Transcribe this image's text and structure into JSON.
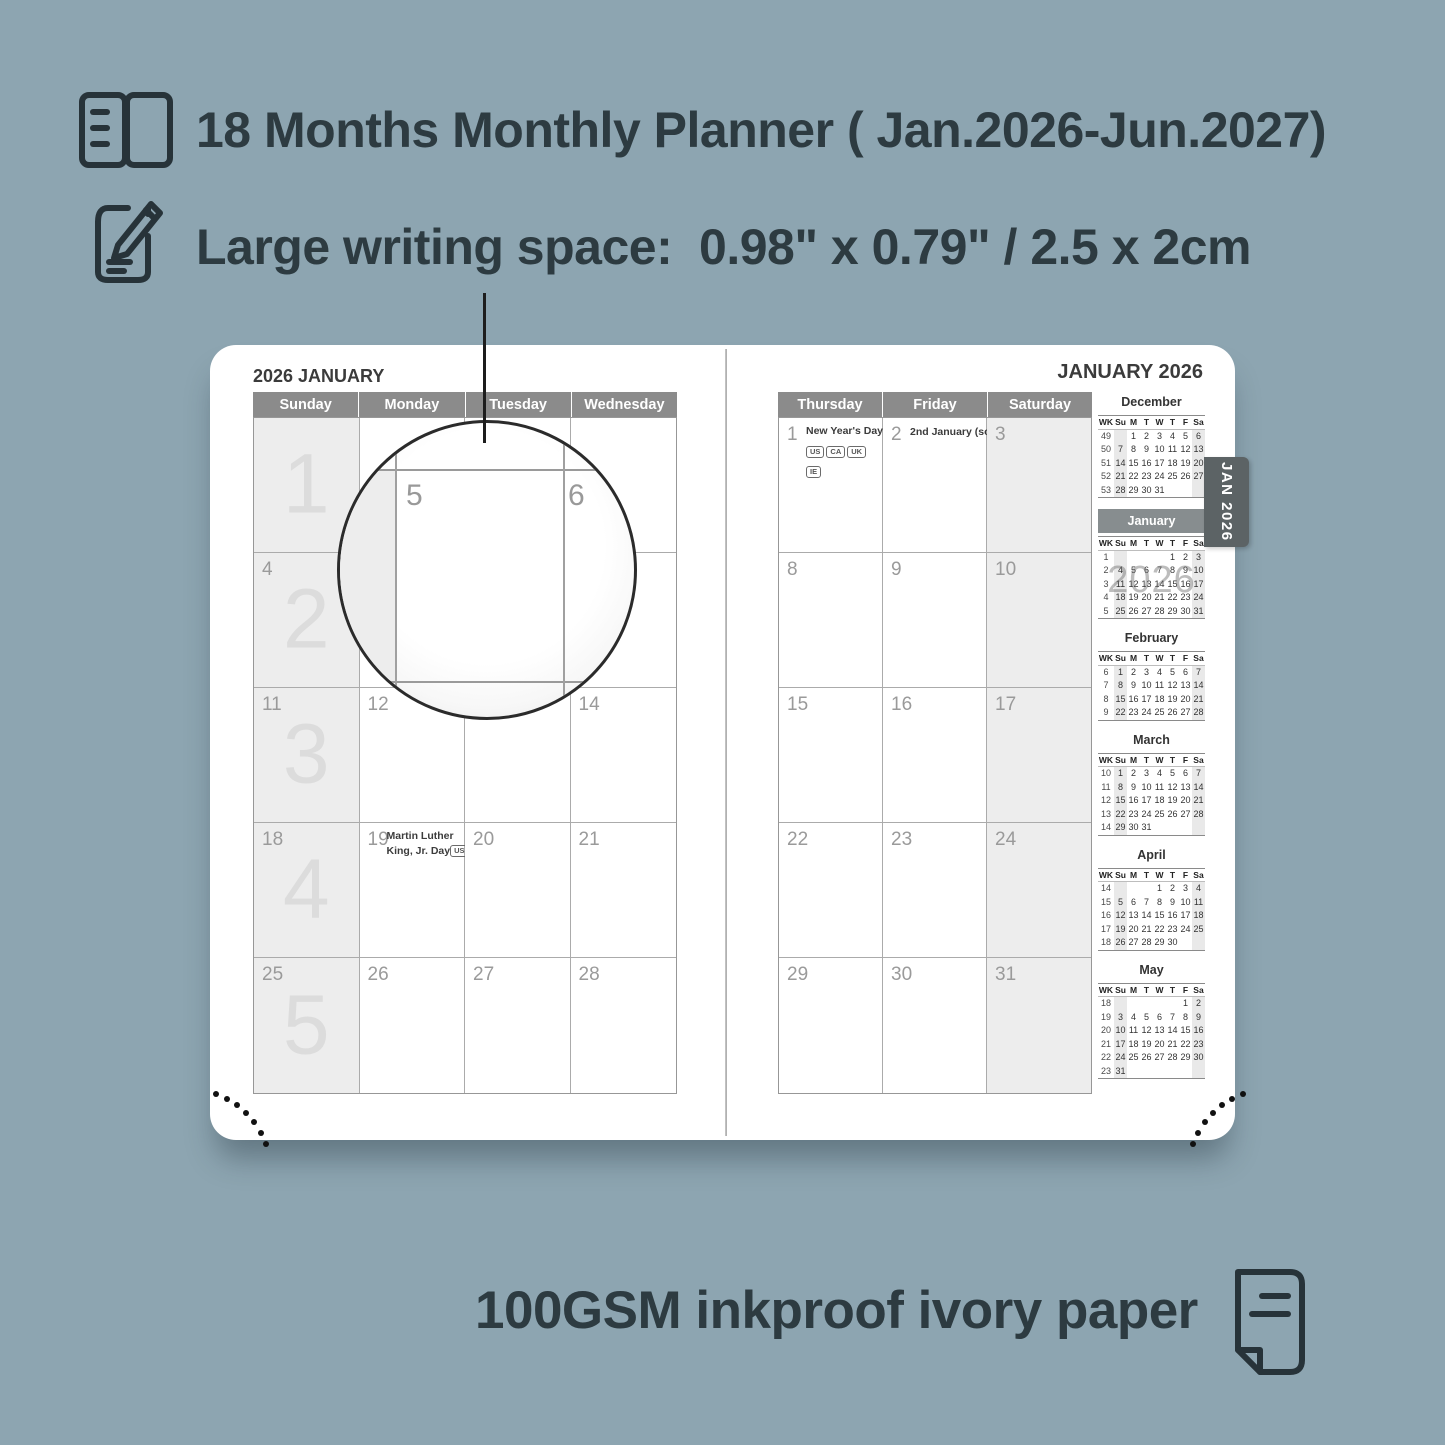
{
  "colors": {
    "background": "#8da5b1",
    "ink": "#2d3b41",
    "day_header_bar": "#8b8b8b",
    "shaded_cell": "#ededed",
    "current_month_bar": "#878d8f",
    "tab": "#5c6365",
    "page": "#ffffff"
  },
  "features": [
    {
      "icon": "open-book-icon",
      "text": "18 Months Monthly Planner ( Jan.2026-Jun.2027)"
    },
    {
      "icon": "pencil-note-icon",
      "text": "Large writing space:  0.98\" x 0.79\" / 2.5 x 2cm"
    }
  ],
  "footer": {
    "icon": "paper-icon",
    "text": "100GSM inkproof ivory paper"
  },
  "magnifier": {
    "cell_dates": [
      "5",
      "6"
    ]
  },
  "tab": {
    "label": "JAN 2026"
  },
  "left_page": {
    "title": "2026 JANUARY",
    "day_headers": [
      "Sunday",
      "Monday",
      "Tuesday",
      "Wednesday"
    ],
    "week_numbers": [
      "1",
      "2",
      "3",
      "4",
      "5"
    ],
    "cells": [
      [
        {
          "date": ""
        },
        {
          "date": ""
        },
        {
          "date": ""
        },
        {
          "date": ""
        }
      ],
      [
        {
          "date": "4"
        },
        {
          "date": "5"
        },
        {
          "date": "6"
        },
        {
          "date": "7"
        }
      ],
      [
        {
          "date": "11"
        },
        {
          "date": "12"
        },
        {
          "date": "13"
        },
        {
          "date": "14"
        }
      ],
      [
        {
          "date": "18"
        },
        {
          "date": "19",
          "holiday": {
            "lines": [
              "Martin Luther",
              "King, Jr. Day"
            ],
            "badges": [
              "US"
            ],
            "badges_inline": true
          }
        },
        {
          "date": "20"
        },
        {
          "date": "21"
        }
      ],
      [
        {
          "date": "25"
        },
        {
          "date": "26"
        },
        {
          "date": "27"
        },
        {
          "date": "28"
        }
      ]
    ]
  },
  "right_page": {
    "title": "JANUARY 2026",
    "day_headers": [
      "Thursday",
      "Friday",
      "Saturday"
    ],
    "cells": [
      [
        {
          "date": "1",
          "holiday": {
            "lines": [
              "New Year's Day"
            ],
            "badges": [
              "US",
              "CA",
              "UK",
              "IE"
            ],
            "badges_inline": false
          }
        },
        {
          "date": "2",
          "holiday": {
            "lines": [
              "2nd January (sc.)"
            ],
            "badges": [
              "UK"
            ],
            "badges_inline": true
          }
        },
        {
          "date": "3"
        }
      ],
      [
        {
          "date": "8"
        },
        {
          "date": "9"
        },
        {
          "date": "10"
        }
      ],
      [
        {
          "date": "15"
        },
        {
          "date": "16"
        },
        {
          "date": "17"
        }
      ],
      [
        {
          "date": "22"
        },
        {
          "date": "23"
        },
        {
          "date": "24"
        }
      ],
      [
        {
          "date": "29"
        },
        {
          "date": "30"
        },
        {
          "date": "31"
        }
      ]
    ]
  },
  "mini_calendars": {
    "columns": [
      "WK",
      "Su",
      "M",
      "T",
      "W",
      "T",
      "F",
      "Sa"
    ],
    "year_watermark": "2026",
    "months": [
      {
        "name": "December",
        "current": false,
        "weeks": [
          {
            "wk": "49",
            "days": [
              "",
              "1",
              "2",
              "3",
              "4",
              "5",
              "6"
            ]
          },
          {
            "wk": "50",
            "days": [
              "7",
              "8",
              "9",
              "10",
              "11",
              "12",
              "13"
            ]
          },
          {
            "wk": "51",
            "days": [
              "14",
              "15",
              "16",
              "17",
              "18",
              "19",
              "20"
            ]
          },
          {
            "wk": "52",
            "days": [
              "21",
              "22",
              "23",
              "24",
              "25",
              "26",
              "27"
            ]
          },
          {
            "wk": "53",
            "days": [
              "28",
              "29",
              "30",
              "31",
              "",
              "",
              ""
            ]
          }
        ]
      },
      {
        "name": "January",
        "current": true,
        "weeks": [
          {
            "wk": "1",
            "days": [
              "",
              "",
              "",
              "",
              "1",
              "2",
              "3"
            ]
          },
          {
            "wk": "2",
            "days": [
              "4",
              "5",
              "6",
              "7",
              "8",
              "9",
              "10"
            ]
          },
          {
            "wk": "3",
            "days": [
              "11",
              "12",
              "13",
              "14",
              "15",
              "16",
              "17"
            ]
          },
          {
            "wk": "4",
            "days": [
              "18",
              "19",
              "20",
              "21",
              "22",
              "23",
              "24"
            ]
          },
          {
            "wk": "5",
            "days": [
              "25",
              "26",
              "27",
              "28",
              "29",
              "30",
              "31"
            ]
          }
        ]
      },
      {
        "name": "February",
        "current": false,
        "weeks": [
          {
            "wk": "6",
            "days": [
              "1",
              "2",
              "3",
              "4",
              "5",
              "6",
              "7"
            ]
          },
          {
            "wk": "7",
            "days": [
              "8",
              "9",
              "10",
              "11",
              "12",
              "13",
              "14"
            ]
          },
          {
            "wk": "8",
            "days": [
              "15",
              "16",
              "17",
              "18",
              "19",
              "20",
              "21"
            ]
          },
          {
            "wk": "9",
            "days": [
              "22",
              "23",
              "24",
              "25",
              "26",
              "27",
              "28"
            ]
          }
        ]
      },
      {
        "name": "March",
        "current": false,
        "weeks": [
          {
            "wk": "10",
            "days": [
              "1",
              "2",
              "3",
              "4",
              "5",
              "6",
              "7"
            ]
          },
          {
            "wk": "11",
            "days": [
              "8",
              "9",
              "10",
              "11",
              "12",
              "13",
              "14"
            ]
          },
          {
            "wk": "12",
            "days": [
              "15",
              "16",
              "17",
              "18",
              "19",
              "20",
              "21"
            ]
          },
          {
            "wk": "13",
            "days": [
              "22",
              "23",
              "24",
              "25",
              "26",
              "27",
              "28"
            ]
          },
          {
            "wk": "14",
            "days": [
              "29",
              "30",
              "31",
              "",
              "",
              "",
              ""
            ]
          }
        ]
      },
      {
        "name": "April",
        "current": false,
        "weeks": [
          {
            "wk": "14",
            "days": [
              "",
              "",
              "",
              "1",
              "2",
              "3",
              "4"
            ]
          },
          {
            "wk": "15",
            "days": [
              "5",
              "6",
              "7",
              "8",
              "9",
              "10",
              "11"
            ]
          },
          {
            "wk": "16",
            "days": [
              "12",
              "13",
              "14",
              "15",
              "16",
              "17",
              "18"
            ]
          },
          {
            "wk": "17",
            "days": [
              "19",
              "20",
              "21",
              "22",
              "23",
              "24",
              "25"
            ]
          },
          {
            "wk": "18",
            "days": [
              "26",
              "27",
              "28",
              "29",
              "30",
              "",
              ""
            ]
          }
        ]
      },
      {
        "name": "May",
        "current": false,
        "weeks": [
          {
            "wk": "18",
            "days": [
              "",
              "",
              "",
              "",
              "",
              "1",
              "2"
            ]
          },
          {
            "wk": "19",
            "days": [
              "3",
              "4",
              "5",
              "6",
              "7",
              "8",
              "9"
            ]
          },
          {
            "wk": "20",
            "days": [
              "10",
              "11",
              "12",
              "13",
              "14",
              "15",
              "16"
            ]
          },
          {
            "wk": "21",
            "days": [
              "17",
              "18",
              "19",
              "20",
              "21",
              "22",
              "23"
            ]
          },
          {
            "wk": "22",
            "days": [
              "24",
              "25",
              "26",
              "27",
              "28",
              "29",
              "30"
            ]
          },
          {
            "wk": "23",
            "days": [
              "31",
              "",
              "",
              "",
              "",
              "",
              ""
            ]
          }
        ]
      }
    ]
  }
}
